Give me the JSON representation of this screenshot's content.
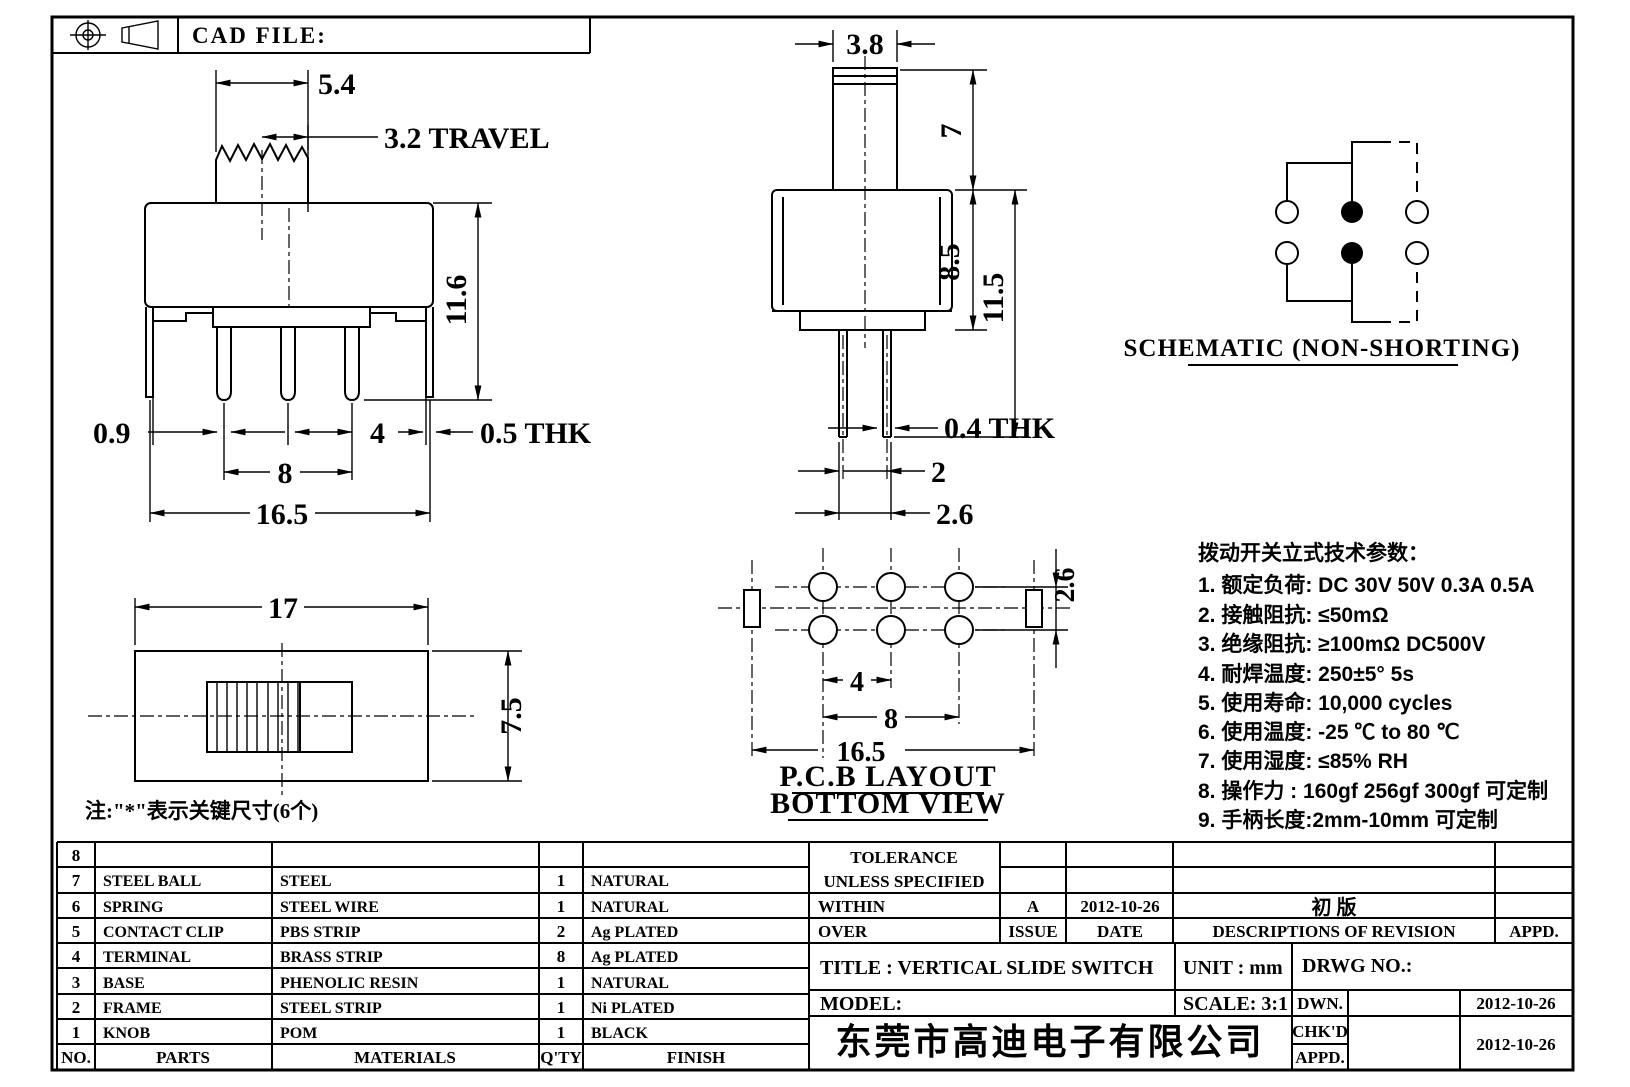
{
  "sheet": {
    "cad_file_label": "CAD FILE:",
    "note": "注:\"*\"表示关键尺寸(6个)"
  },
  "front_view": {
    "dim_54": "5.4",
    "dim_travel": "3.2 TRAVEL",
    "dim_116": "11.6",
    "dim_09": "0.9",
    "dim_4": "4",
    "dim_05thk": "0.5 THK",
    "dim_8": "8",
    "dim_165": "16.5"
  },
  "side_view": {
    "dim_38": "3.8",
    "dim_7": "7",
    "dim_85": "8.5",
    "dim_115": "11.5",
    "dim_04thk": "0.4 THK",
    "dim_2": "2",
    "dim_26": "2.6"
  },
  "schematic": {
    "label": "SCHEMATIC (NON-SHORTING)"
  },
  "top_view": {
    "dim_17": "17",
    "dim_75": "7.5"
  },
  "pcb_view": {
    "dim_4": "4",
    "dim_8": "8",
    "dim_165": "16.5",
    "dim_26": "2.6",
    "label_line1": "P.C.B LAYOUT",
    "label_line2": "BOTTOM VIEW"
  },
  "specs": {
    "title": "拨动开关立式技术参数：",
    "items": [
      "1.  额定负荷: DC 30V    50V    0.3A    0.5A",
      "2.  接触阻抗: ≤50mΩ",
      "3.  绝缘阻抗: ≥100mΩ   DC500V",
      "4.  耐焊温度: 250±5°  5s",
      "5.  使用寿命: 10,000 cycles",
      "6.  使用温度: -25 ℃  to 80 ℃",
      "7.  使用湿度: ≤85% RH",
      "8.  操作力 : 160gf   256gf   300gf  可定制",
      "9.  手柄长度:2mm-10mm  可定制"
    ]
  },
  "parts_table": {
    "headers": [
      "NO.",
      "PARTS",
      "MATERIALS",
      "Q'TY",
      "FINISH"
    ],
    "rows": [
      [
        "8",
        "",
        "",
        "",
        ""
      ],
      [
        "7",
        "STEEL BALL",
        "STEEL",
        "1",
        "NATURAL"
      ],
      [
        "6",
        "SPRING",
        "STEEL WIRE",
        "1",
        "NATURAL"
      ],
      [
        "5",
        "CONTACT CLIP",
        "PBS STRIP",
        "2",
        "Ag PLATED"
      ],
      [
        "4",
        "TERMINAL",
        "BRASS STRIP",
        "8",
        "Ag PLATED"
      ],
      [
        "3",
        "BASE",
        "PHENOLIC RESIN",
        "1",
        "NATURAL"
      ],
      [
        "2",
        "FRAME",
        "STEEL STRIP",
        "1",
        "Ni PLATED"
      ],
      [
        "1",
        "KNOB",
        "POM",
        "1",
        "BLACK"
      ]
    ]
  },
  "title_block": {
    "tolerance_line1": "TOLERANCE",
    "tolerance_line2": "UNLESS  SPECIFIED",
    "within": "WITHIN",
    "over": "OVER",
    "rev_issue_value": "A",
    "rev_date_value": "2012-10-26",
    "rev_desc_value": "初  版",
    "issue_header": "ISSUE",
    "date_header": "DATE",
    "descriptions_header": "DESCRIPTIONS OF REVISION",
    "appd_header": "APPD.",
    "title": "TITLE :   VERTICAL  SLIDE  SWITCH",
    "unit": "UNIT :   mm",
    "model": "MODEL:",
    "scale": "SCALE:   3:1",
    "drwg": "DRWG  NO.:",
    "dwn": "DWN.",
    "chkd": "CHK'D",
    "appd": "APPD.",
    "dwn_date": "2012-10-26",
    "chk_date": "2012-10-26",
    "company": "东莞市高迪电子有限公司"
  }
}
